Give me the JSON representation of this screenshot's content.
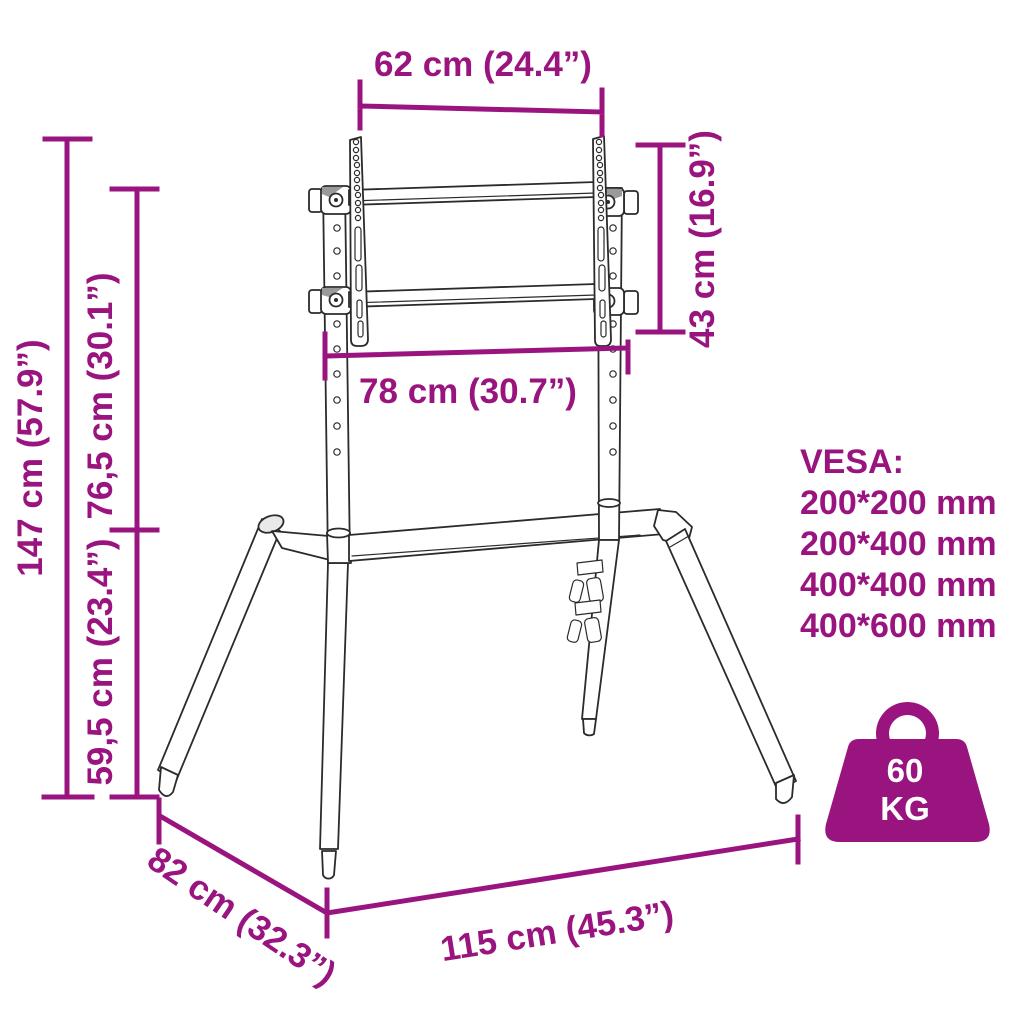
{
  "colors": {
    "accent": "#9A147F",
    "drawing_line": "#2b2b2b",
    "background": "#ffffff"
  },
  "dimensions": {
    "top_width": "62 cm (24.4”)",
    "vesa_bracket_height": "43 cm (16.9”)",
    "bracket_width": "78 cm (30.7”)",
    "total_height": "147 cm (57.9”)",
    "upper_height": "76,5 cm (30.1”)",
    "lower_height": "59,5 cm (23.4”)",
    "base_depth": "82 cm (32.3”)",
    "base_width": "115 cm (45.3”)"
  },
  "vesa": {
    "title": "VESA:",
    "sizes": [
      "200*200 mm",
      "200*400 mm",
      "400*400 mm",
      "400*600 mm"
    ]
  },
  "load": {
    "value": "60",
    "unit": "KG"
  }
}
